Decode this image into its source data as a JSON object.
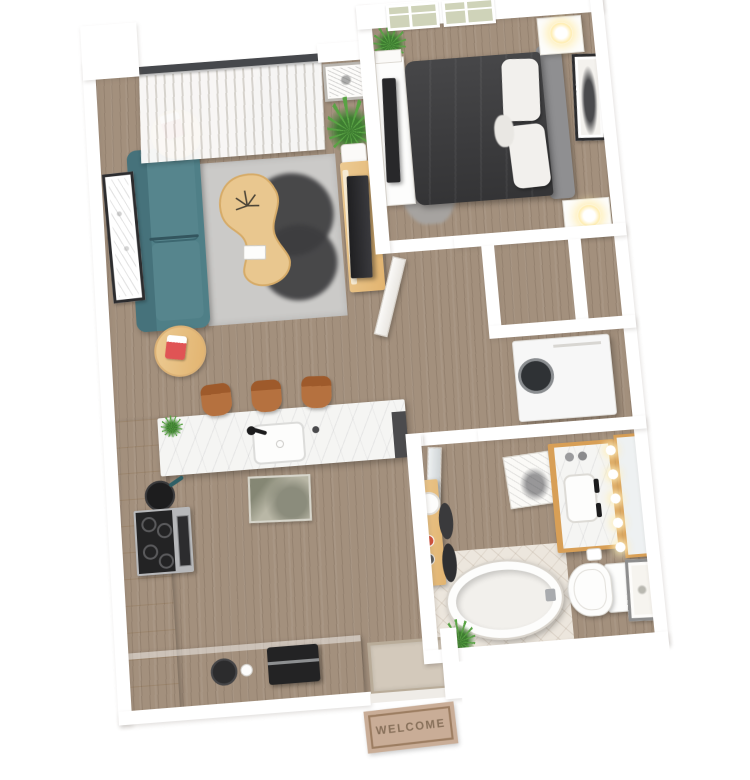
{
  "scene": {
    "type": "3d-rendered-one-bedroom-floor-plan",
    "background": "#ffffff"
  },
  "entry": {
    "welcome_mat_text": "WELCOME"
  },
  "palette": {
    "wall": "#ffffff",
    "wall_shade": "#e7e4df",
    "floor_wood": "#a3907d",
    "tile": "#ece6dd",
    "sofa": "#4f7f87",
    "sofa_light": "#56858d",
    "rug": "#cbcac8",
    "rug_accent": "#3d3d3f",
    "wood_light": "#ecca92",
    "wood_mid": "#e2b470",
    "vanity_wood": "#d89f56",
    "marble": "#f5f5f3",
    "bed": "#3b3b3d",
    "headboard": "#8f8f91",
    "pillow": "#f2f0ed",
    "stool": "#b5713f",
    "steel": "#b7b8ba",
    "appliance_black": "#232324",
    "washer": "#f7f7f7",
    "mat": "#c9ad97",
    "mat_text": "#87705a",
    "plant": "#59a344",
    "plant_dark": "#3e7d31",
    "glow": "#ffedb0",
    "window_pane": "#cfd3b9",
    "rail": "#46484c"
  },
  "rooms": [
    {
      "name": "living-room",
      "items": [
        "teal-sofa",
        "round-side-table-1",
        "round-side-table-2",
        "snack-box-1",
        "snack-box-2",
        "area-rug",
        "dark-rug-accent",
        "kidney-coffee-table",
        "dried-plant",
        "card",
        "tv-stand",
        "tv",
        "vertical-blinds",
        "patio-rail",
        "west-wall-art",
        "north-wall-art",
        "fern-plant"
      ]
    },
    {
      "name": "bedroom",
      "items": [
        "queen-bed",
        "duvet",
        "headboard",
        "pillows",
        "shag-rug",
        "dresser",
        "tv",
        "nightstand-north",
        "nightstand-south",
        "lamp-north",
        "lamp-south",
        "window-1",
        "window-2",
        "east-wall-art",
        "corner-plant"
      ]
    },
    {
      "name": "hallway",
      "items": [
        "closet-1",
        "closet-2",
        "open-door-panel"
      ]
    },
    {
      "name": "laundry-closet",
      "items": [
        "washer-dryer"
      ]
    },
    {
      "name": "bathroom",
      "items": [
        "vanity",
        "marble-top",
        "sink",
        "black-faucets",
        "mirror",
        "vanity-bulbs",
        "toilet",
        "toilet-paper",
        "leaning-art",
        "floor-art",
        "bathtub",
        "tile-floor",
        "door-panel"
      ]
    },
    {
      "name": "kitchen",
      "items": [
        "peninsula-counter",
        "kitchen-sink",
        "black-faucet",
        "bar-stool-1",
        "bar-stool-2",
        "bar-stool-3",
        "west-cabinets",
        "range-stove",
        "frying-pan",
        "floor-mat",
        "south-counter",
        "coffee-maker",
        "kettle",
        "cup",
        "counter-plant"
      ]
    },
    {
      "name": "entry",
      "items": [
        "door-opening",
        "door-stub",
        "interior-doormat",
        "welcome-mat",
        "entry-plant",
        "console-table",
        "tray",
        "red-cup",
        "dark-cup",
        "leaning-plates"
      ]
    }
  ]
}
